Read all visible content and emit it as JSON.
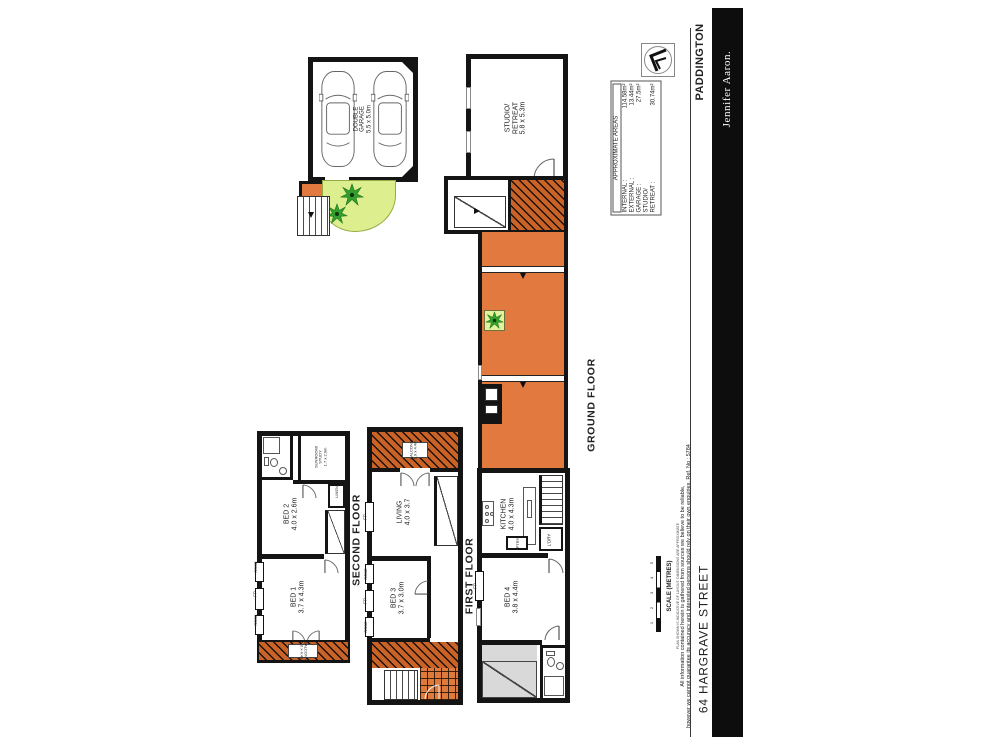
{
  "branding": {
    "suburb": "PADDINGTON",
    "agency": "Jennifer Aaron.",
    "address": "64 HARGRAVE STREET"
  },
  "areas": {
    "title": "APPROXIMATE AREAS",
    "rows": [
      {
        "label": "INTERNAL :",
        "value": "114.58m²"
      },
      {
        "label": "EXTERNAL :",
        "value": "13.44m²"
      },
      {
        "label": "GARAGE :",
        "value": "27.5m²"
      },
      {
        "label": "STUDIO/",
        "value": ""
      },
      {
        "label": "RETREAT :",
        "value": "30.74m²"
      }
    ]
  },
  "floor_labels": {
    "ground": "GROUND FLOOR",
    "first": "FIRST FLOOR",
    "second": "SECOND FLOOR"
  },
  "rooms": {
    "garage": {
      "line1": "DOUBLE",
      "line2": "GARAGE",
      "dims": "5.5 x 5.0m"
    },
    "studio": {
      "line1": "STUDIO/",
      "line2": "RETREAT",
      "dims": "5.8 x 5.3m"
    },
    "kitchen": {
      "name": "KITCHEN",
      "dims": "4.0 x 4.3m"
    },
    "bed4": {
      "name": "BED 4",
      "dims": "3.8 x 4.4m"
    },
    "living": {
      "name": "LIVING",
      "dims": "4.0 x 3.7"
    },
    "bed3": {
      "name": "BED 3",
      "dims": "3.7 x 3.0m"
    },
    "bed2": {
      "name": "BED 2",
      "dims": "4.0 x 2.6m"
    },
    "bed1": {
      "name": "BED 1",
      "dims": "3.7 x 4.3m"
    },
    "sunroom": {
      "line1": "SUNROOM/",
      "line2": "STUDY",
      "dims": "1.7 x 2.9m"
    },
    "balcony_first": {
      "name": "BALCONY",
      "dims": "1.9 x 4.4m"
    },
    "balcony_second": {
      "name": "BALCONY",
      "dims": "1.0 x 4.4m"
    }
  },
  "small_labels": {
    "fp": "FP",
    "robe": "ROBE",
    "linen": "LINEN",
    "laundry": "L'DRY",
    "pantry": "PTRY"
  },
  "scale": {
    "label": "SCALE (METRES)",
    "ticks": [
      "1",
      "2",
      "3",
      "4",
      "5"
    ],
    "note": "PLAN SHOWN IS INDICATIVE OF LAYOUT. DIMENSIONS ARE APPROXIMATE"
  },
  "disclaimer": {
    "line1": "All information contained herein is gathered from sources we believe to be reliable,",
    "line2": "however we cannot guarantee its accuracy and interested persons should rely on their own enquiries. Ref. No : 5784"
  },
  "colors": {
    "paving": "#e2793f",
    "hatch_base": "#c96327",
    "garden": "#dcee8e",
    "plant": "#33a02c",
    "bar": "#0d0d0d"
  }
}
